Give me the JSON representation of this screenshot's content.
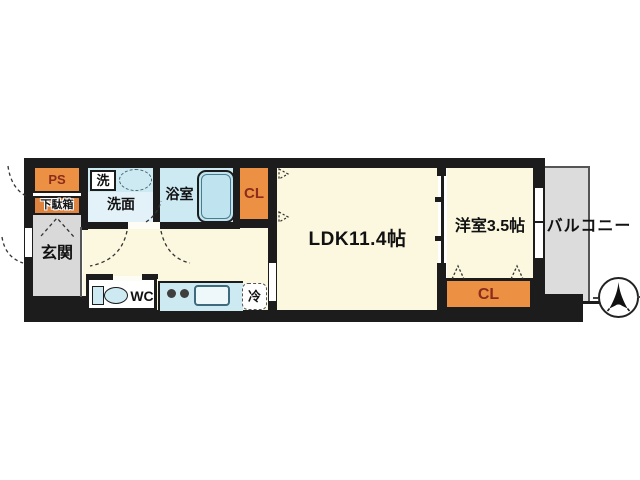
{
  "plan": {
    "title": "1LDK apartment floor plan",
    "labels": {
      "ps": "PS",
      "shoe_box": "下駄箱",
      "entrance": "玄関",
      "washer": "洗",
      "washroom": "洗面",
      "bathroom": "浴室",
      "closet_upper": "CL",
      "wc": "WC",
      "fridge": "冷",
      "ldk": "LDK11.4帖",
      "western_room": "洋室3.5帖",
      "closet_lower": "CL",
      "balcony": "バルコニー"
    },
    "colors": {
      "wall": "#1c1c1c",
      "closet_orange": "#ec9143",
      "shoe_box_orange": "#df8440",
      "accent_text": "#8b2c1c",
      "floor_yellow": "#fbf8df",
      "floor_blue": "#cde9f2",
      "floor_blue_light": "#e3f2f8",
      "entrance_gray": "#d9d9d9",
      "balcony_gray": "#dcdcdc",
      "tub_blue": "#bfe4ef"
    },
    "compass": {
      "direction": "north-up"
    }
  }
}
